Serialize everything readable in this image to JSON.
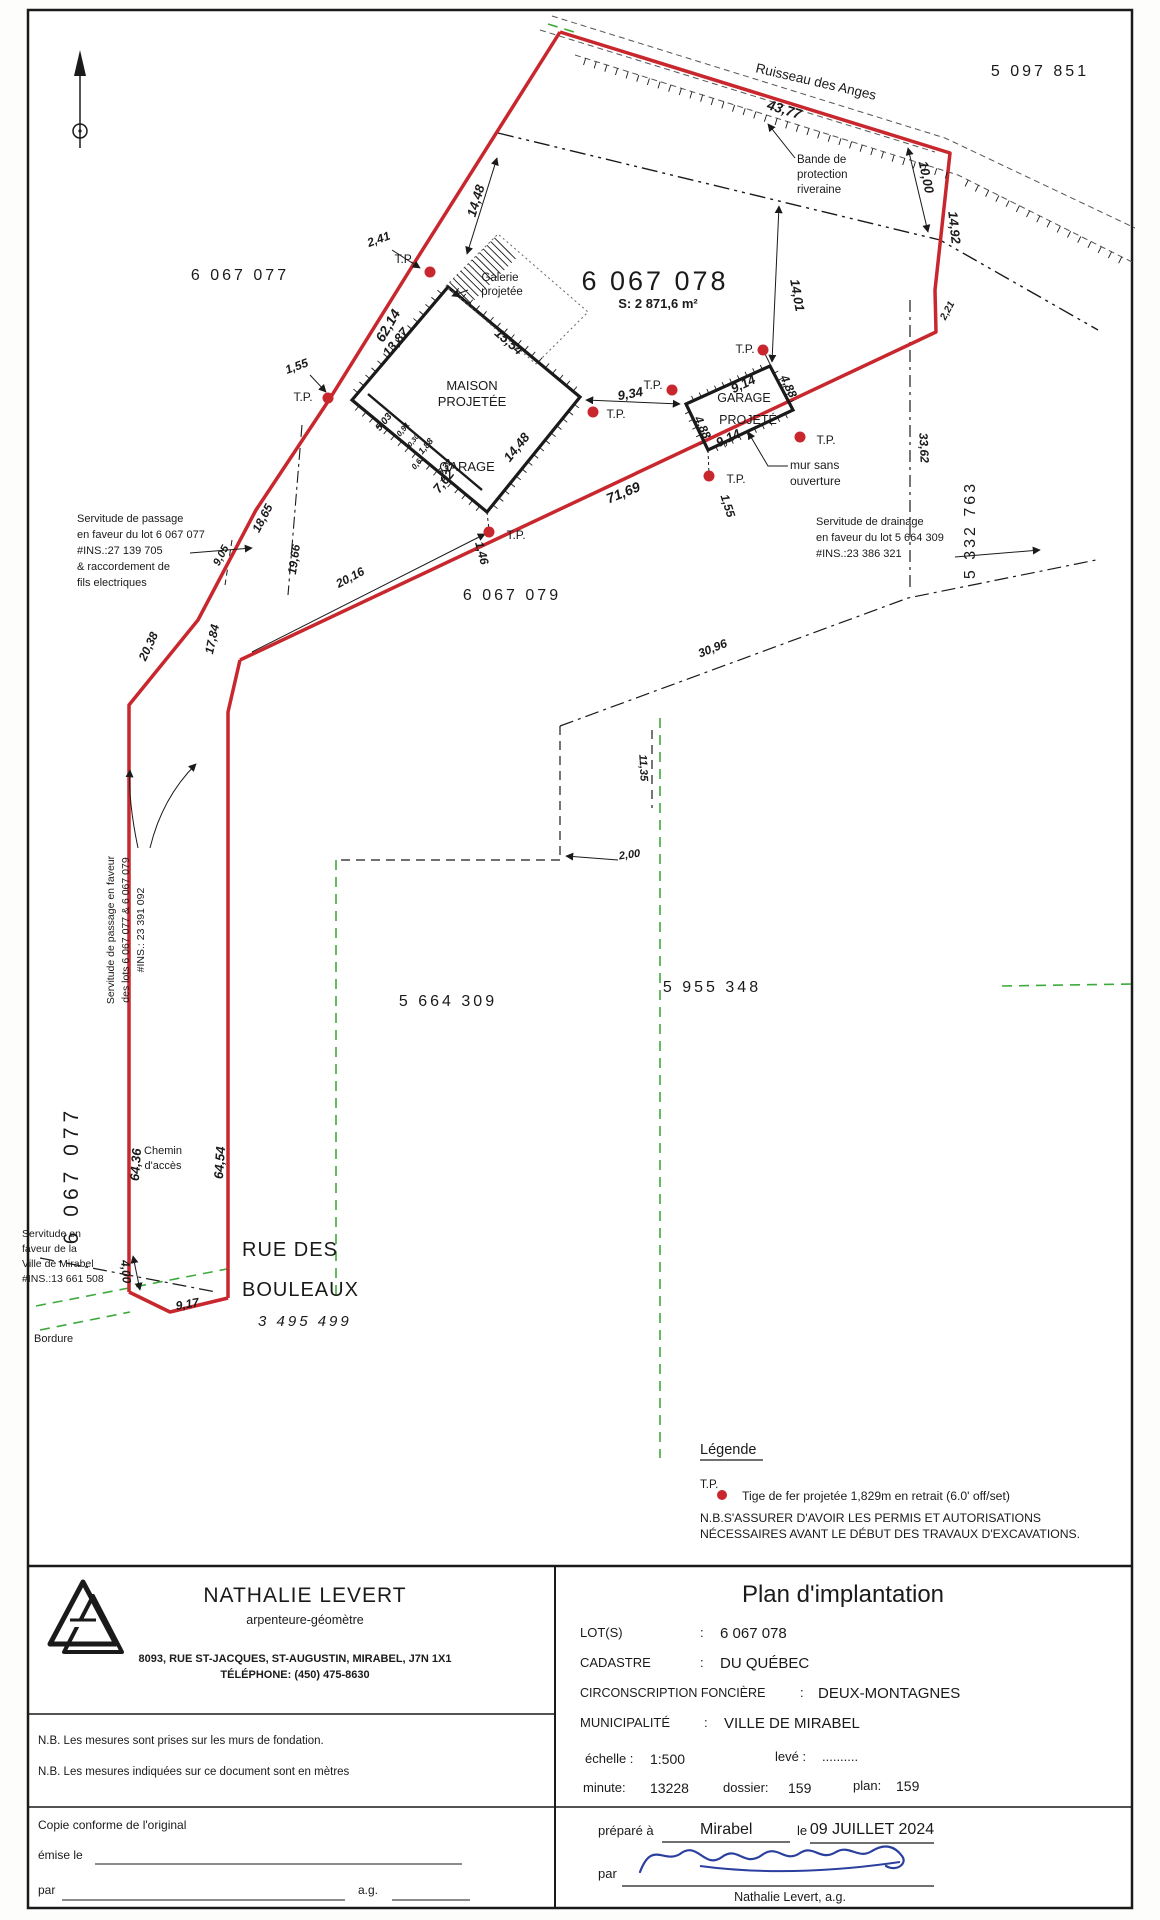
{
  "plan": {
    "stream": "Ruisseau des Anges",
    "lot_top_right": "5 097 851",
    "lot_upper_left": "6 067 077",
    "lot_main": "6 067 078",
    "lot_main_area": "S: 2 871,6 m²",
    "lot_below": "6 067 079",
    "lot_right": "5 332 763",
    "lot_left_vertical": "6 067 077",
    "lot_sw": "5 664 309",
    "lot_se": "5 955 348",
    "lot_street": "3 495 499",
    "street_line1": "RUE DES",
    "street_line2": "BOULEAUX",
    "tp": "T.P.",
    "galerie": [
      "Galerie",
      "projetée"
    ],
    "bande": [
      "Bande de",
      "protection",
      "riveraine"
    ],
    "maison": [
      "MAISON",
      "PROJETÉE"
    ],
    "garage": "GARAGE",
    "garage_projete": [
      "GARAGE",
      "PROJETÉ"
    ],
    "mur": [
      "mur sans",
      "ouverture"
    ],
    "chemin": [
      "Chemin",
      "d'accès"
    ],
    "bordure": "Bordure",
    "servitude_passage_1": [
      "Servitude de passage",
      "en faveur du lot 6 067 077",
      "#INS.:27 139 705",
      "& raccordement de",
      "fils electriques"
    ],
    "servitude_drainage": [
      "Servitude de drainage",
      "en faveur du lot 5 664 309",
      "#INS.:23 386 321"
    ],
    "servitude_passage_2": [
      "Servitude de passage en faveur",
      "des lots 6 067 077 & 6 067 079",
      "#INS.: 23 391 092"
    ],
    "servitude_ville": [
      "Servitude en",
      "faveur de la",
      "Ville de Mirabel",
      "#INS.:13 661 508"
    ],
    "dims": {
      "d43_77": "43,77",
      "d10_00": "10,00",
      "d14_92": "14,92",
      "d2_21": "2,21",
      "d14_48a": "14,48",
      "d2_41": "2,41",
      "d62_14": "62,14",
      "d1_55a": "1,55",
      "d15_54": "15,54",
      "d13_87": "13,87",
      "d14_01": "14,01",
      "d9_34": "9,34",
      "d9_14a": "9,14",
      "d4_88a": "4,88",
      "d9_14b": "9,14",
      "d4_88b": "4,88",
      "d14_48b": "14,48",
      "d7_62": "7,62",
      "d1_46": "1,46",
      "d71_69": "71,69",
      "d1_55b": "1,55",
      "d20_16": "20,16",
      "d18_65": "18,65",
      "d19_66": "19,66",
      "d9_05": "9,05",
      "d20_38": "20,38",
      "d17_84": "17,84",
      "d33_62": "33,62",
      "d30_96": "30,96",
      "d2_00": "2,00",
      "d11_35": "11,35",
      "d64_36": "64,36",
      "d64_54": "64,54",
      "d4_00": "4,00",
      "d9_17": "9,17",
      "d5_03": "5,03",
      "d0_91": "0,91",
      "d0_30": "0,30",
      "d1_88": "1,88",
      "d0_61": "0,61",
      "d5_32": "5,32"
    }
  },
  "legend": {
    "title": "Légende",
    "tp": "T.P.",
    "tp_desc": "Tige de fer projetée 1,829m en retrait (6.0' off/set)",
    "nb1": "N.B.S'ASSURER D'AVOIR LES PERMIS ET AUTORISATIONS",
    "nb2": "NÉCESSAIRES AVANT LE DÉBUT DES TRAVAUX D'EXCAVATIONS."
  },
  "titleblock": {
    "surveyor_name": "NATHALIE LEVERT",
    "surveyor_title": "arpenteure-géomètre",
    "address": "8093, RUE ST-JACQUES, ST-AUGUSTIN, MIRABEL, J7N 1X1",
    "phone": "TÉLÉPHONE: (450) 475-8630",
    "nb_fondation": "N.B. Les mesures sont prises sur les murs de fondation.",
    "nb_metres": "N.B. Les mesures indiquées sur ce document sont en  mètres",
    "copie": "Copie conforme de l'original",
    "emise": "émise le",
    "par_left": "par",
    "ag_left": "a.g.",
    "doc_title": "Plan d'implantation",
    "rows": [
      {
        "label": "LOT(S)",
        "sep": ":",
        "value": "6 067 078"
      },
      {
        "label": "CADASTRE",
        "sep": ":",
        "value": "DU QUÉBEC"
      },
      {
        "label": "CIRCONSCRIPTION FONCIÈRE",
        "sep": ":",
        "value": "DEUX-MONTAGNES"
      },
      {
        "label": "MUNICIPALITÉ",
        "sep": ":",
        "value": "VILLE DE MIRABEL"
      }
    ],
    "echelle_label": "échelle :",
    "echelle_value": "1:500",
    "leve_label": "levé :",
    "leve_value": "..........",
    "minute_label": "minute:",
    "minute_value": "13228",
    "dossier_label": "dossier:",
    "dossier_value": "159",
    "plan_label": "plan:",
    "plan_value": "159",
    "prepare_label": "préparé à",
    "prepare_value": "Mirabel",
    "le_label": "le",
    "date_value": "09 JUILLET 2024",
    "par_label": "par",
    "signed_name": "Nathalie Levert, a.g."
  },
  "colors": {
    "boundary_red": "#c8272d",
    "green_dash": "#3faa3c",
    "signature_blue": "#2b3f9e"
  }
}
